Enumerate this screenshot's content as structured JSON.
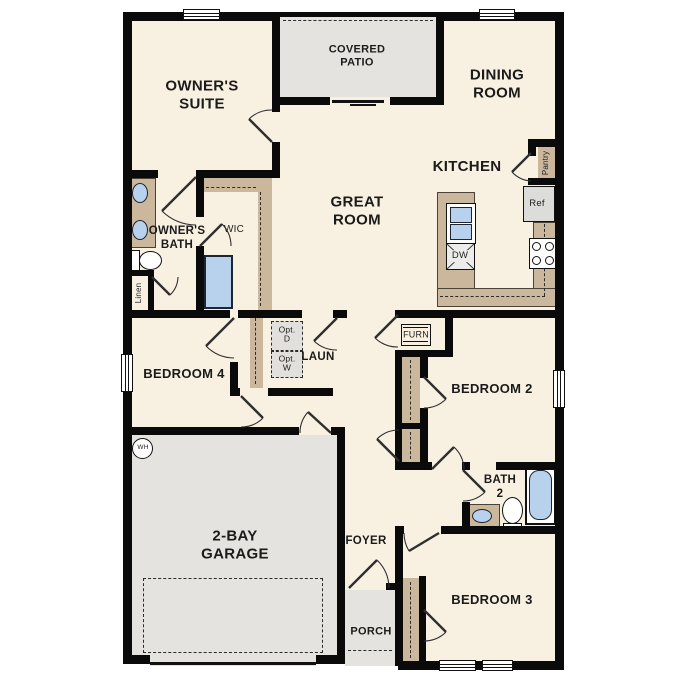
{
  "floorplan": {
    "rooms": {
      "owners_suite": {
        "lines": [
          "OWNER'S",
          "SUITE"
        ]
      },
      "covered_patio": {
        "lines": [
          "COVERED",
          "PATIO"
        ]
      },
      "dining_room": {
        "lines": [
          "DINING",
          "ROOM"
        ]
      },
      "great_room": {
        "lines": [
          "GREAT",
          "ROOM"
        ]
      },
      "kitchen": {
        "label": "KITCHEN"
      },
      "owners_bath": {
        "lines": [
          "OWNER'S",
          "BATH"
        ]
      },
      "wic": {
        "label": "WIC"
      },
      "laundry": {
        "label": "LAUN"
      },
      "bedroom_4": {
        "label": "BEDROOM 4"
      },
      "bedroom_2": {
        "label": "BEDROOM 2"
      },
      "bedroom_3": {
        "label": "BEDROOM 3"
      },
      "bath_2": {
        "lines": [
          "BATH",
          "2"
        ]
      },
      "garage": {
        "lines": [
          "2-BAY",
          "GARAGE"
        ]
      },
      "foyer": {
        "label": "FOYER"
      },
      "porch": {
        "label": "PORCH"
      }
    },
    "features": {
      "pantry": "Pantry",
      "linen": "Linen",
      "refrigerator": "Ref",
      "dishwasher": "DW",
      "furnace": "FURN",
      "water_heater": "WH",
      "opt_dryer": {
        "lines": [
          "Opt.",
          "D"
        ]
      },
      "opt_washer": {
        "lines": [
          "Opt.",
          "W"
        ]
      }
    },
    "colors": {
      "floor": "#f8f0e1",
      "wall": "#0a0a0a",
      "counter_tan": "#cbb79b",
      "fixture_blue": "#b8d1ec",
      "concrete_gray": "#e4e3df",
      "appliance_gray": "#dcdcda"
    }
  }
}
